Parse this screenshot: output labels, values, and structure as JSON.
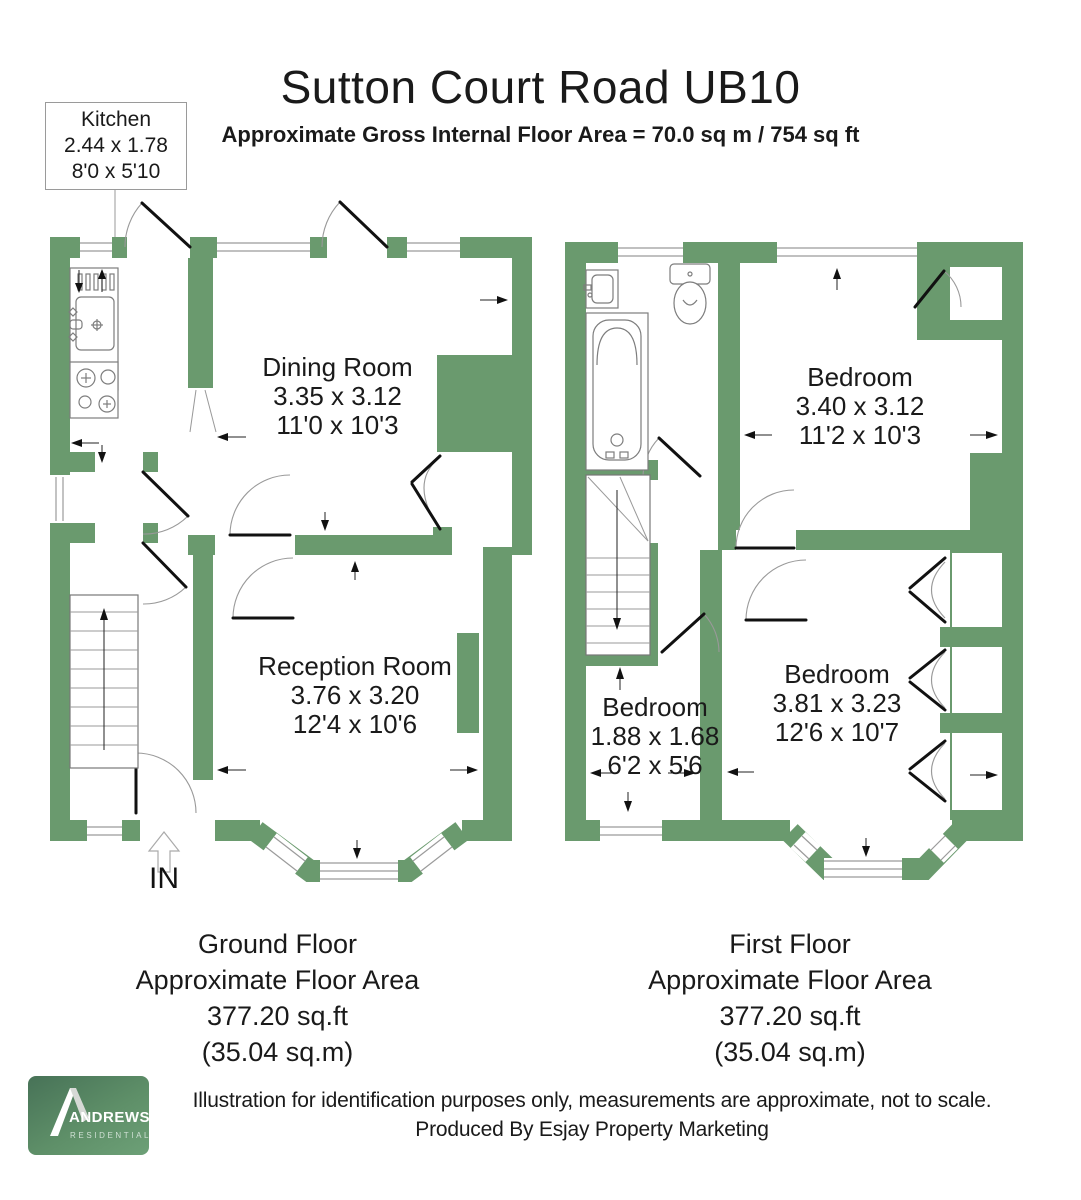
{
  "header": {
    "title": "Sutton Court Road UB10",
    "subtitle": "Approximate Gross Internal Floor Area = 70.0 sq m / 754 sq ft"
  },
  "kitchen_label": {
    "name": "Kitchen",
    "metric": "2.44 x 1.78",
    "imperial": "8'0 x 5'10"
  },
  "ground_floor": {
    "entrance_label": "IN",
    "rooms": [
      {
        "name": "Dining Room",
        "metric": "3.35 x 3.12",
        "imperial": "11'0 x 10'3"
      },
      {
        "name": "Reception Room",
        "metric": "3.76 x 3.20",
        "imperial": "12'4 x 10'6"
      }
    ],
    "caption": {
      "line1": "Ground Floor",
      "line2": "Approximate Floor Area",
      "line3": "377.20 sq.ft",
      "line4": "(35.04 sq.m)"
    }
  },
  "first_floor": {
    "rooms": [
      {
        "name": "Bedroom",
        "metric": "3.40 x 3.12",
        "imperial": "11'2 x 10'3"
      },
      {
        "name": "Bedroom",
        "metric": "1.88 x 1.68",
        "imperial": "6'2 x 5'6"
      },
      {
        "name": "Bedroom",
        "metric": "3.81 x 3.23",
        "imperial": "12'6 x 10'7"
      }
    ],
    "caption": {
      "line1": "First Floor",
      "line2": "Approximate Floor Area",
      "line3": "377.20 sq.ft",
      "line4": "(35.04 sq.m)"
    }
  },
  "footer": {
    "logo": {
      "brand": "ANDREWS",
      "tagline": "RESIDENTIAL"
    },
    "disclaimer_line1": "Illustration for identification purposes only, measurements are approximate, not to scale.",
    "disclaimer_line2": "Produced By Esjay Property Marketing"
  },
  "colors": {
    "wall_green": "#6a9a6e",
    "logo_dark": "#477257",
    "logo_light": "#6da077"
  }
}
